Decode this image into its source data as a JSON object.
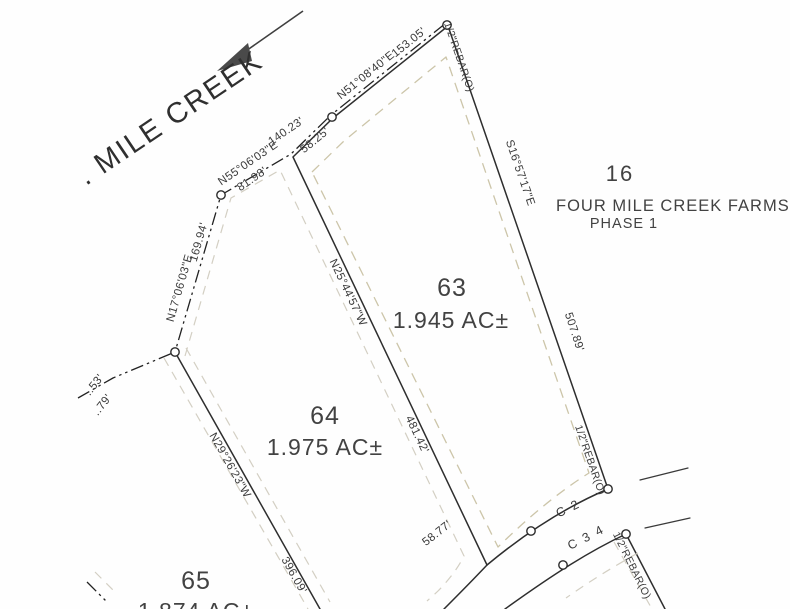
{
  "colors": {
    "lot_highlight": "#f6f1b6",
    "boundary": "#2e2e2e",
    "setback_dash": "#ccc5a9",
    "text": "#3a3a3a"
  },
  "creek": {
    "label": ". MILE CREEK"
  },
  "lots": {
    "lot63": {
      "number": "63",
      "area": "1.945 AC±"
    },
    "lot64": {
      "number": "64",
      "area": "1.975 AC±"
    },
    "lot65": {
      "number": "65",
      "area": "1.874 AC±"
    }
  },
  "adjacent": {
    "number": "16",
    "subdivision": "FOUR MILE CREEK FARMS",
    "phase": "PHASE 1"
  },
  "dimensions": {
    "top_bearing": "N51°08'40\"E",
    "top_distance": "153.05'",
    "creek_bearing_upper": "N55°06'03\"E",
    "creek_distance_upper": "140.23'",
    "lot63_creek_frontage": "58.25'",
    "lot64_creek_frontage": "81.98'",
    "creek_bearing_lower": "N17°06'03\"E",
    "creek_distance_lower": "169.94'",
    "east_bearing": "S16°57'17\"E",
    "east_distance": "507.89'",
    "lot63_west_bearing": "N25°44'57\"W",
    "lot63_west_distance": "481.42'",
    "lot65_line_bearing": "N29°26'23\"W",
    "lot65_line_distance": "396.09'",
    "road_frontage": "58.77'",
    "fragment_53": "..53'",
    "fragment_79": "..79'"
  },
  "curves": {
    "c2": "C 2",
    "c34": "C 3 4"
  },
  "monuments": {
    "rebar": "1/2\"REBAR(O)"
  }
}
